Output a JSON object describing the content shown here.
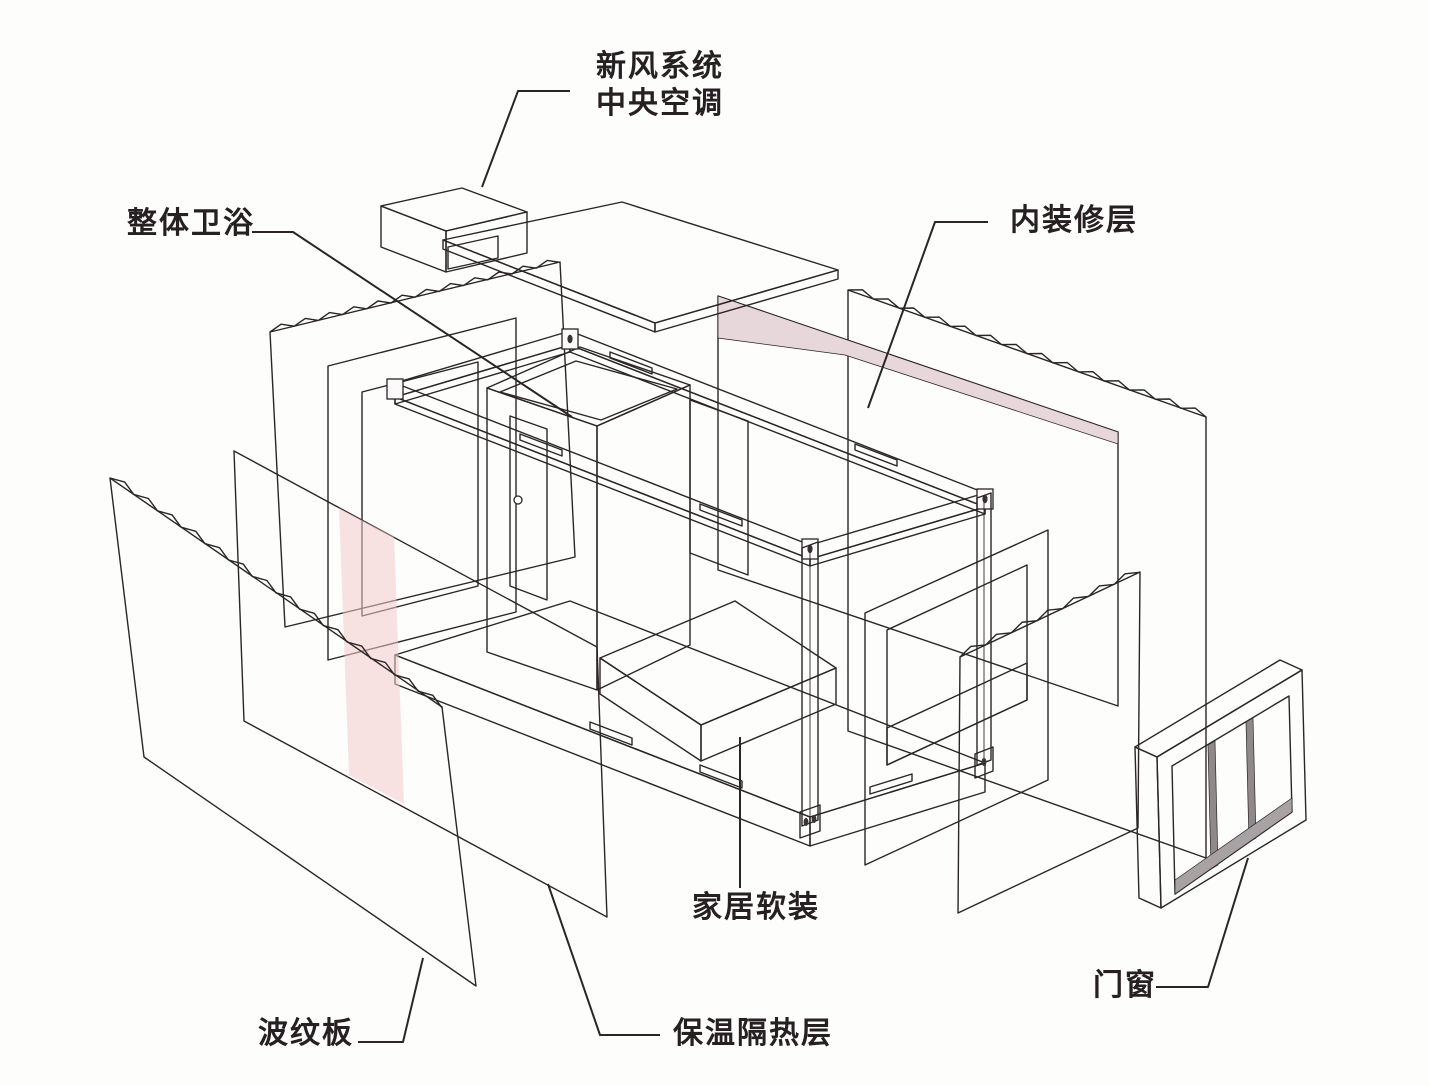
{
  "diagram": {
    "type": "exploded-axonometric-diagram",
    "subject": "container-house-construction-layers",
    "labels": {
      "hvac_line1": "新风系统",
      "hvac_line2": "中央空调",
      "integrated_bathroom": "整体卫浴",
      "interior_finish_layer": "内装修层",
      "home_soft_furnishing": "家居软装",
      "thermal_insulation_layer": "保温隔热层",
      "corrugated_panel": "波纹板",
      "doors_windows": "门窗"
    },
    "colors": {
      "background": "#fdfdfc",
      "line": "#2b2526",
      "accent_pink": "#e7d7da",
      "door_pink": "#e3d3d6",
      "stripe_pink": "#f3caca",
      "floor_pink": "#dccfd3",
      "rib_shade": "#cdc5c7",
      "mullion_gray": "#8f898b"
    }
  }
}
